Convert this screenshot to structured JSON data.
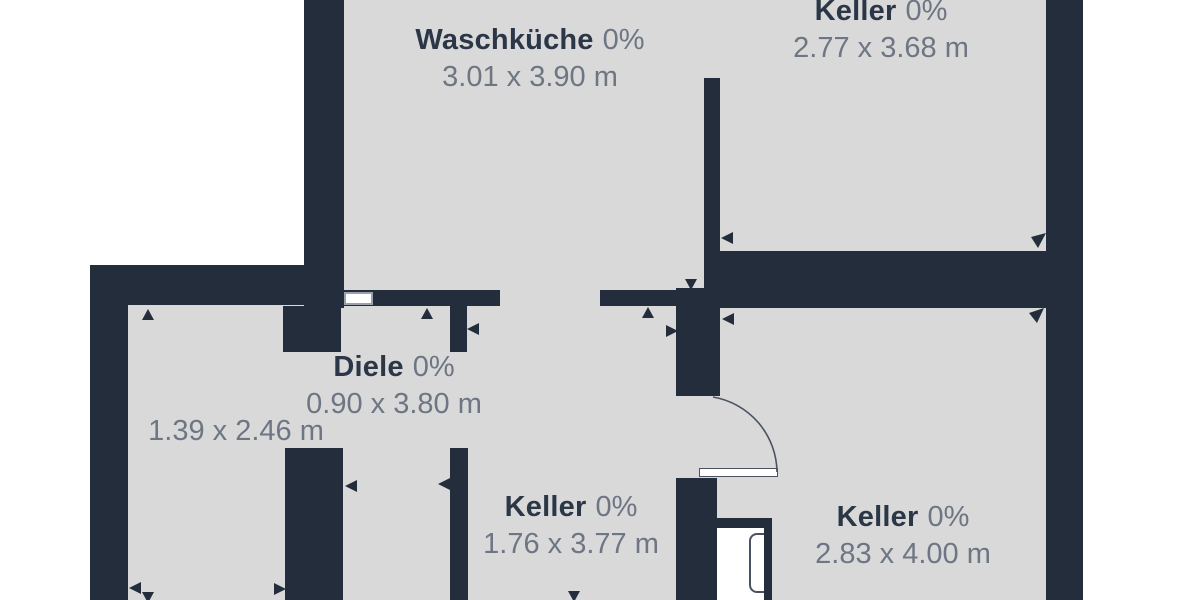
{
  "rooms": {
    "waschkueche": {
      "name": "Waschküche",
      "occupancy": "0%",
      "dimensions": "3.01 x 3.90 m"
    },
    "keller_top_right": {
      "name": "Keller",
      "occupancy": "0%",
      "dimensions": "2.77 x 3.68 m"
    },
    "diele": {
      "name": "Diele",
      "occupancy": "0%",
      "dimensions": "0.90 x 3.80 m"
    },
    "room_left": {
      "dimensions": "1.39 x 2.46 m"
    },
    "keller_middle": {
      "name": "Keller",
      "occupancy": "0%",
      "dimensions": "1.76 x 3.77 m"
    },
    "keller_bottom_right": {
      "name": "Keller",
      "occupancy": "0%",
      "dimensions": "2.83 x 4.00 m"
    }
  },
  "colors": {
    "wall": "#232d3c",
    "floor_fill": "#d9d9d9",
    "background": "#ffffff",
    "room_name_text": "#2b3647",
    "dimension_text": "#6e7684",
    "fixture_outline": "#4a5261",
    "window_frame": "#9aa1ab"
  },
  "markers": {
    "measurement_arrow": "small dark triangle",
    "door_swing": "quarter-circle arc",
    "window": "white inset rectangle in wall"
  }
}
